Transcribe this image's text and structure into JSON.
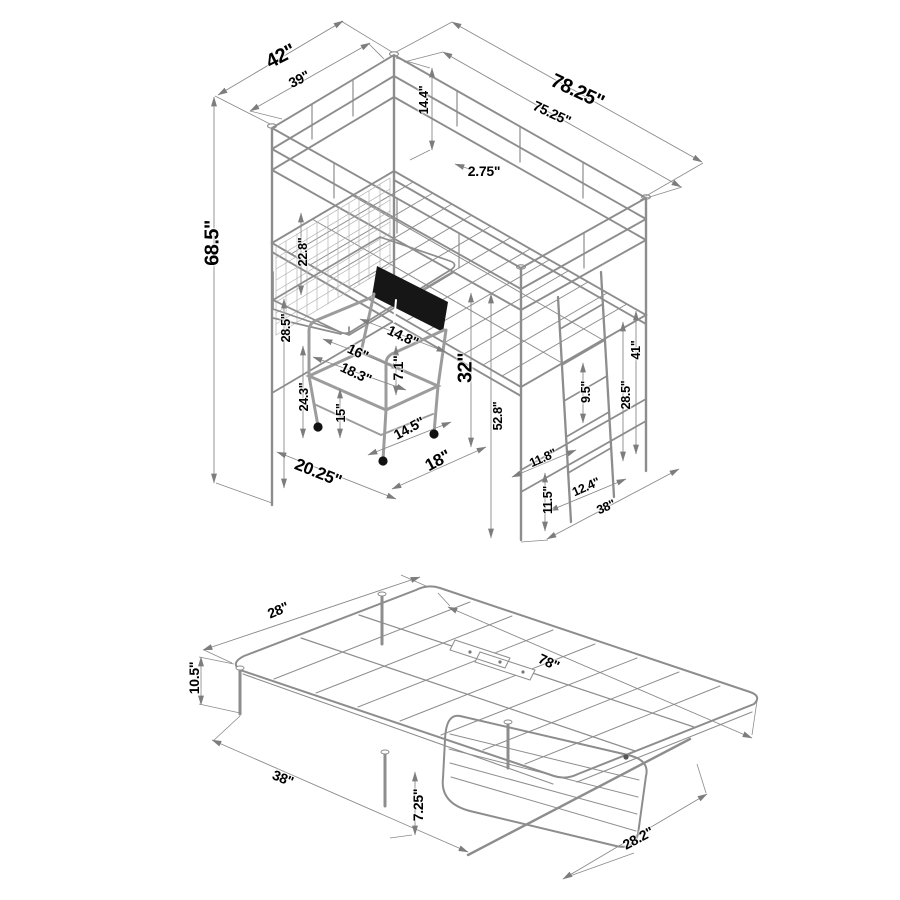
{
  "colors": {
    "background": "#ffffff",
    "line": "#8d8d8d",
    "dim_line": "#8a8a8a",
    "mesh": "#b2b2b2",
    "text": "#000000",
    "chair_backrest": "#161616",
    "caster": "#111111"
  },
  "unit": "\"",
  "figures": {
    "loft_bed": {
      "labels": [
        {
          "text": "42\"",
          "x": 281,
          "y": 57,
          "rot": -27,
          "size": "xl"
        },
        {
          "text": "39\"",
          "x": 299,
          "y": 79,
          "rot": -27,
          "size": "m"
        },
        {
          "text": "78.25\"",
          "x": 577,
          "y": 92,
          "rot": 25,
          "size": "xl"
        },
        {
          "text": "75.25\"",
          "x": 552,
          "y": 113,
          "rot": 25,
          "size": "m"
        },
        {
          "text": "14.4\"",
          "x": 424,
          "y": 100,
          "rot": -90,
          "size": "s"
        },
        {
          "text": "2.75\"",
          "x": 484,
          "y": 171,
          "rot": 0,
          "size": "m"
        },
        {
          "text": "68.5\"",
          "x": 213,
          "y": 243,
          "rot": -90,
          "size": "xl"
        },
        {
          "text": "22.8\"",
          "x": 303,
          "y": 252,
          "rot": -90,
          "size": "s"
        },
        {
          "text": "28.5\"",
          "x": 286,
          "y": 328,
          "rot": -90,
          "size": "s"
        },
        {
          "text": "14.8\"",
          "x": 403,
          "y": 336,
          "rot": 25,
          "size": "m"
        },
        {
          "text": "16\"",
          "x": 358,
          "y": 352,
          "rot": 25,
          "size": "m"
        },
        {
          "text": "18.3\"",
          "x": 356,
          "y": 373,
          "rot": 25,
          "size": "m"
        },
        {
          "text": "7.1\"",
          "x": 398,
          "y": 368,
          "rot": -90,
          "size": "m"
        },
        {
          "text": "32\"",
          "x": 466,
          "y": 368,
          "rot": -90,
          "size": "xl"
        },
        {
          "text": "24.3\"",
          "x": 304,
          "y": 397,
          "rot": -90,
          "size": "s"
        },
        {
          "text": "15\"",
          "x": 341,
          "y": 413,
          "rot": -90,
          "size": "s"
        },
        {
          "text": "14.5\"",
          "x": 409,
          "y": 428,
          "rot": -28,
          "size": "m"
        },
        {
          "text": "20.25\"",
          "x": 318,
          "y": 473,
          "rot": 22,
          "size": "l"
        },
        {
          "text": "18\"",
          "x": 438,
          "y": 461,
          "rot": -28,
          "size": "l"
        },
        {
          "text": "52.8\"",
          "x": 498,
          "y": 416,
          "rot": -90,
          "size": "s"
        },
        {
          "text": "11.8\"",
          "x": 543,
          "y": 458,
          "rot": -24,
          "size": "s"
        },
        {
          "text": "11.5\"",
          "x": 548,
          "y": 500,
          "rot": -90,
          "size": "s"
        },
        {
          "text": "12.4\"",
          "x": 586,
          "y": 487,
          "rot": -24,
          "size": "s"
        },
        {
          "text": "9.5\"",
          "x": 586,
          "y": 392,
          "rot": -90,
          "size": "s"
        },
        {
          "text": "28.5\"",
          "x": 626,
          "y": 395,
          "rot": -90,
          "size": "s"
        },
        {
          "text": "41\"",
          "x": 636,
          "y": 350,
          "rot": -90,
          "size": "s"
        },
        {
          "text": "38\"",
          "x": 606,
          "y": 507,
          "rot": -24,
          "size": "s"
        }
      ]
    },
    "futon": {
      "labels": [
        {
          "text": "28\"",
          "x": 278,
          "y": 610,
          "rot": -23,
          "size": "m"
        },
        {
          "text": "10.5\"",
          "x": 194,
          "y": 678,
          "rot": -90,
          "size": "m"
        },
        {
          "text": "78\"",
          "x": 549,
          "y": 662,
          "rot": 25,
          "size": "m"
        },
        {
          "text": "38\"",
          "x": 283,
          "y": 778,
          "rot": 22,
          "size": "m"
        },
        {
          "text": "7.25\"",
          "x": 418,
          "y": 805,
          "rot": -90,
          "size": "m"
        },
        {
          "text": "28.2\"",
          "x": 638,
          "y": 838,
          "rot": -28,
          "size": "m"
        }
      ]
    }
  }
}
